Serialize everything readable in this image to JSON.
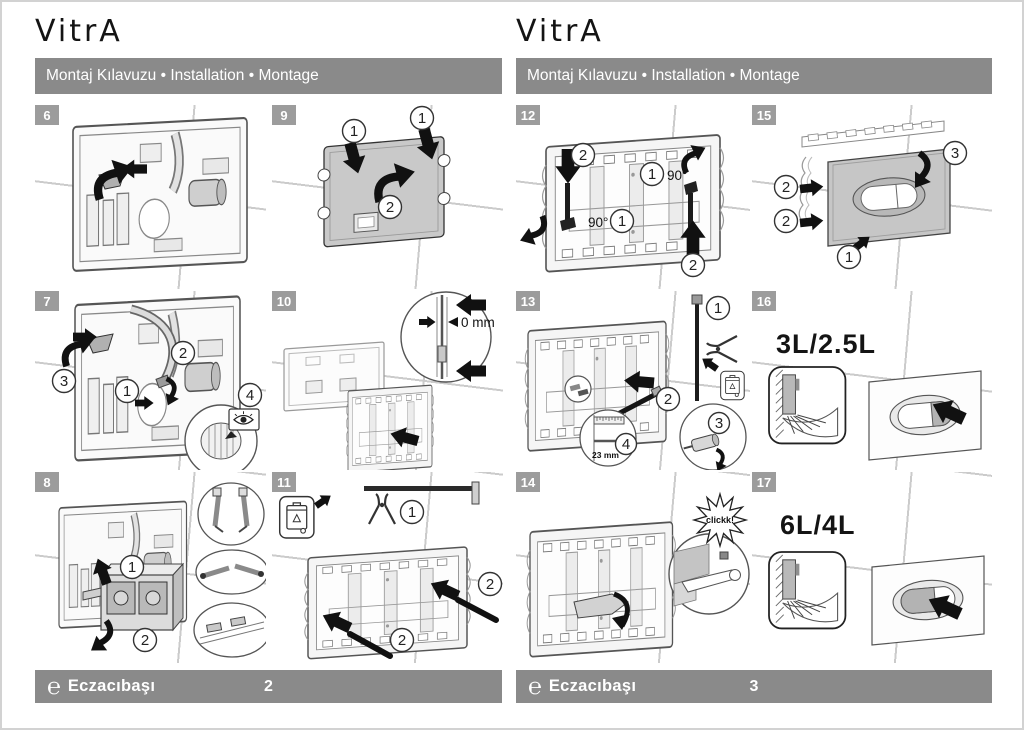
{
  "logo": "VitrA",
  "title": "Montaj Kılavuzu • Installation • Montage",
  "footer": {
    "logo_char": "℮",
    "brand": "Eczacıbaşı",
    "page_left": "2",
    "page_right": "3"
  },
  "steps": {
    "s6": {
      "num": "6"
    },
    "s7": {
      "num": "7",
      "c": [
        "1",
        "2",
        "3",
        "4"
      ]
    },
    "s8": {
      "num": "8",
      "c": [
        "1",
        "2"
      ]
    },
    "s9": {
      "num": "9",
      "c": [
        "1",
        "1",
        "2"
      ]
    },
    "s10": {
      "num": "10",
      "zero_mm": "0 mm"
    },
    "s11": {
      "num": "11",
      "c": [
        "1",
        "2",
        "2"
      ]
    },
    "s12": {
      "num": "12",
      "c": [
        "2",
        "1",
        "1",
        "2"
      ],
      "deg": "90°"
    },
    "s13": {
      "num": "13",
      "c": [
        "1",
        "2",
        "3",
        "4"
      ],
      "mm23": "23 mm"
    },
    "s14": {
      "num": "14",
      "click": "clickk!"
    },
    "s15": {
      "num": "15",
      "c": [
        "2",
        "2",
        "1",
        "3"
      ]
    },
    "s16": {
      "num": "16",
      "volume": "3L/2.5L"
    },
    "s17": {
      "num": "17",
      "volume": "6L/4L"
    }
  }
}
